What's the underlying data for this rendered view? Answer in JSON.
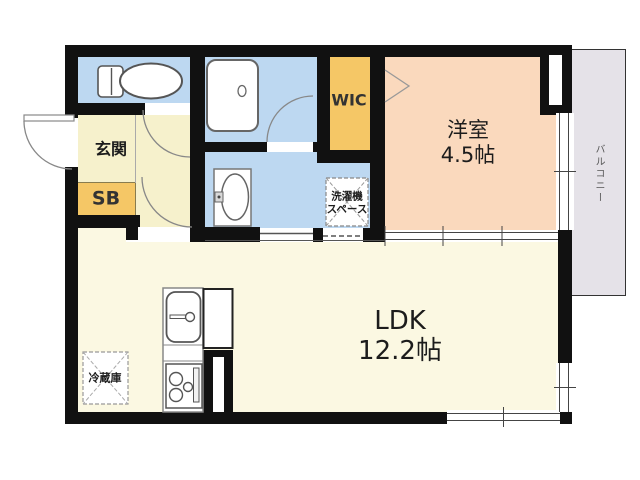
{
  "rooms": {
    "entrance": {
      "label": "玄関"
    },
    "shoe_box": {
      "label": "SB"
    },
    "walk_in_closet": {
      "label": "WIC"
    },
    "western_room": {
      "label": "洋室",
      "size": "4.5帖"
    },
    "ldk": {
      "label": "LDK",
      "size": "12.2帖"
    },
    "washer_space": {
      "line1": "洗濯機",
      "line2": "スペース"
    },
    "refrigerator": {
      "label": "冷蔵庫"
    },
    "balcony": {
      "label": "バルコニー"
    }
  },
  "colors": {
    "wall": "#111111",
    "water_rooms": "#BDD8F1",
    "entrance_hall": "#F6F1CC",
    "ldk_floor": "#FBF8E2",
    "storage_accent": "#F5C766",
    "western_room_floor": "#FAD9BD",
    "balcony_floor": "#E5E2E8"
  }
}
